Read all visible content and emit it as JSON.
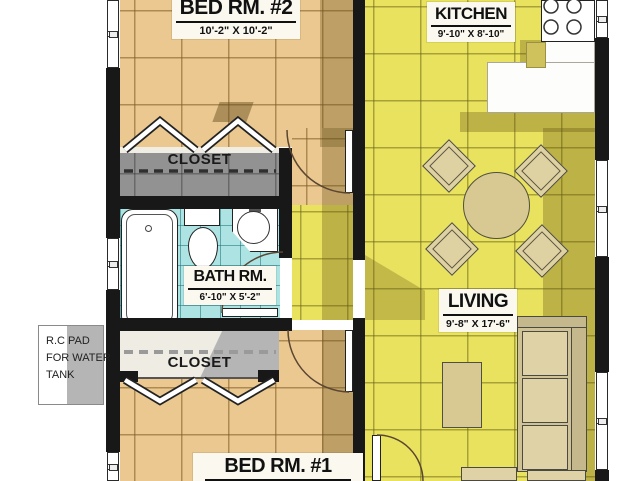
{
  "plan": {
    "title": "apartment-floor-plan",
    "rooms": {
      "bed2": {
        "name": "BED RM. #2",
        "dims": "10'-2\" X 10'-2\""
      },
      "kitchen": {
        "name": "KITCHEN",
        "dims": "9'-10\" X 8'-10\""
      },
      "bath": {
        "name": "BATH RM.",
        "dims": "6'-10\" X 5'-2\""
      },
      "living": {
        "name": "LIVING",
        "dims": "9'-8\" X 17'-6\""
      },
      "bed1": {
        "name": "BED RM. #1"
      },
      "closet_top": {
        "name": "CLOSET"
      },
      "closet_bottom": {
        "name": "CLOSET"
      }
    },
    "annotations": {
      "water_tank_pad": {
        "lines": [
          "R.C PAD",
          "FOR WATER",
          "TANK"
        ]
      }
    },
    "colors": {
      "bedroom_floor": "#eac88f",
      "kitchen_living_floor": "#e8e25e",
      "bath_floor": "#aee3e3",
      "closet_floor": "#929292",
      "wall": "#181818",
      "fixture": "#ffffff",
      "furniture": "#d8c992",
      "shadow": "#60501a"
    }
  }
}
